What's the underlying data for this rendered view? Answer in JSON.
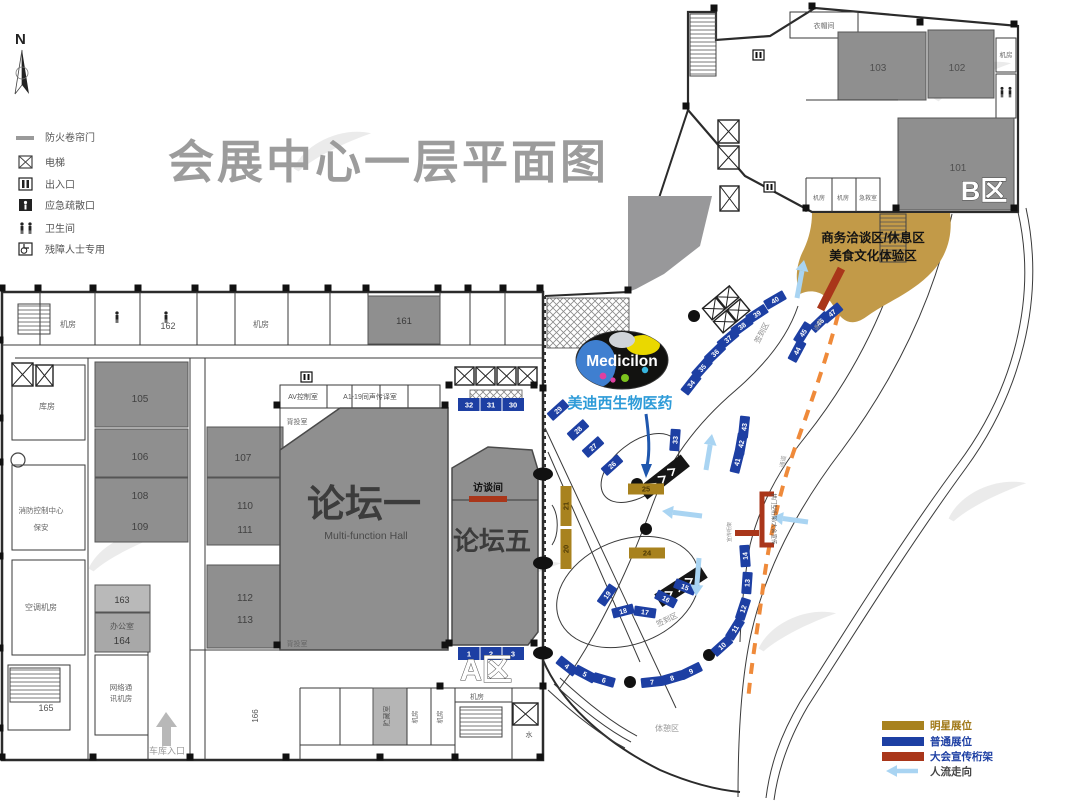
{
  "title": "会展中心一层平面图",
  "compass": "N",
  "legend_top": {
    "items": [
      {
        "icon": "fire-shutter-icon",
        "label": "防火卷帘门"
      },
      {
        "icon": "elevator-icon",
        "label": "电梯"
      },
      {
        "icon": "entrance-icon",
        "label": "出入口"
      },
      {
        "icon": "emergency-exit-icon",
        "label": "应急疏散口"
      },
      {
        "icon": "restroom-icon",
        "label": "卫生间"
      },
      {
        "icon": "accessible-icon",
        "label": "残障人士专用"
      }
    ]
  },
  "legend_bottom": {
    "items": [
      {
        "swatch": "star-booth",
        "color": "#a8821e",
        "label": "明星展位",
        "label_color": "#a07818"
      },
      {
        "swatch": "standard-booth",
        "color": "#1d3fa3",
        "label": "普通展位",
        "label_color": "#1d3fa3"
      },
      {
        "swatch": "truss",
        "color": "#a9361a",
        "label": "大会宣传桁架",
        "label_color": "#1d3fa3"
      },
      {
        "swatch": "flow-arrow",
        "color": "#a9d4f2",
        "label": "人流走向",
        "label_color": "#444444"
      }
    ]
  },
  "halls": {
    "forum1": {
      "name": "论坛一",
      "subtitle": "Multi-function Hall"
    },
    "forum5": {
      "name": "论坛五"
    },
    "interview_room": "访谈间",
    "zone_a": "A区",
    "zone_b": "B区"
  },
  "zones": {
    "business_line1": "商务洽谈区/休息区",
    "business_line2": "美食文化体验区",
    "rest_area": "体憩区",
    "checkin": "签到区",
    "passage": "通道",
    "arch_truss": "拱门型桁架/大会宣传",
    "truss": "宣传桁架",
    "garage_entrance": "车库入口"
  },
  "medicilon": {
    "logo": "Medicilon",
    "caption": "美迪西生物医药"
  },
  "room_labels": [
    "机房",
    "162",
    "机房",
    "161",
    "库房",
    "105",
    "106",
    "108",
    "109",
    "107",
    "110",
    "111",
    "112",
    "113",
    "消防控制中心",
    "保安",
    "空调机房",
    "163",
    "办公室",
    "164",
    "网络通",
    "讯机房",
    "165",
    "166",
    "AV控制室",
    "A1-19同声传译室",
    "背投室",
    "背投室",
    "101",
    "102",
    "103",
    "衣帽间",
    "机房",
    "机房",
    "机房",
    "急救室",
    "水",
    "机房",
    "机房",
    "机房",
    "贮藏室"
  ],
  "booths": {
    "bars": [
      [
        "1",
        "2",
        "3"
      ],
      [
        "32",
        "31",
        "30"
      ]
    ],
    "standard": [
      "4",
      "5",
      "6",
      "7",
      "8",
      "9",
      "10",
      "11",
      "12",
      "13",
      "14",
      "15",
      "16",
      "17",
      "18",
      "19",
      "26",
      "27",
      "28",
      "29",
      "33",
      "34",
      "35",
      "36",
      "37",
      "38",
      "39",
      "40",
      "41",
      "42",
      "43",
      "44",
      "45",
      "46",
      "47"
    ],
    "star": [
      "21",
      "20",
      "25",
      "24"
    ]
  }
}
